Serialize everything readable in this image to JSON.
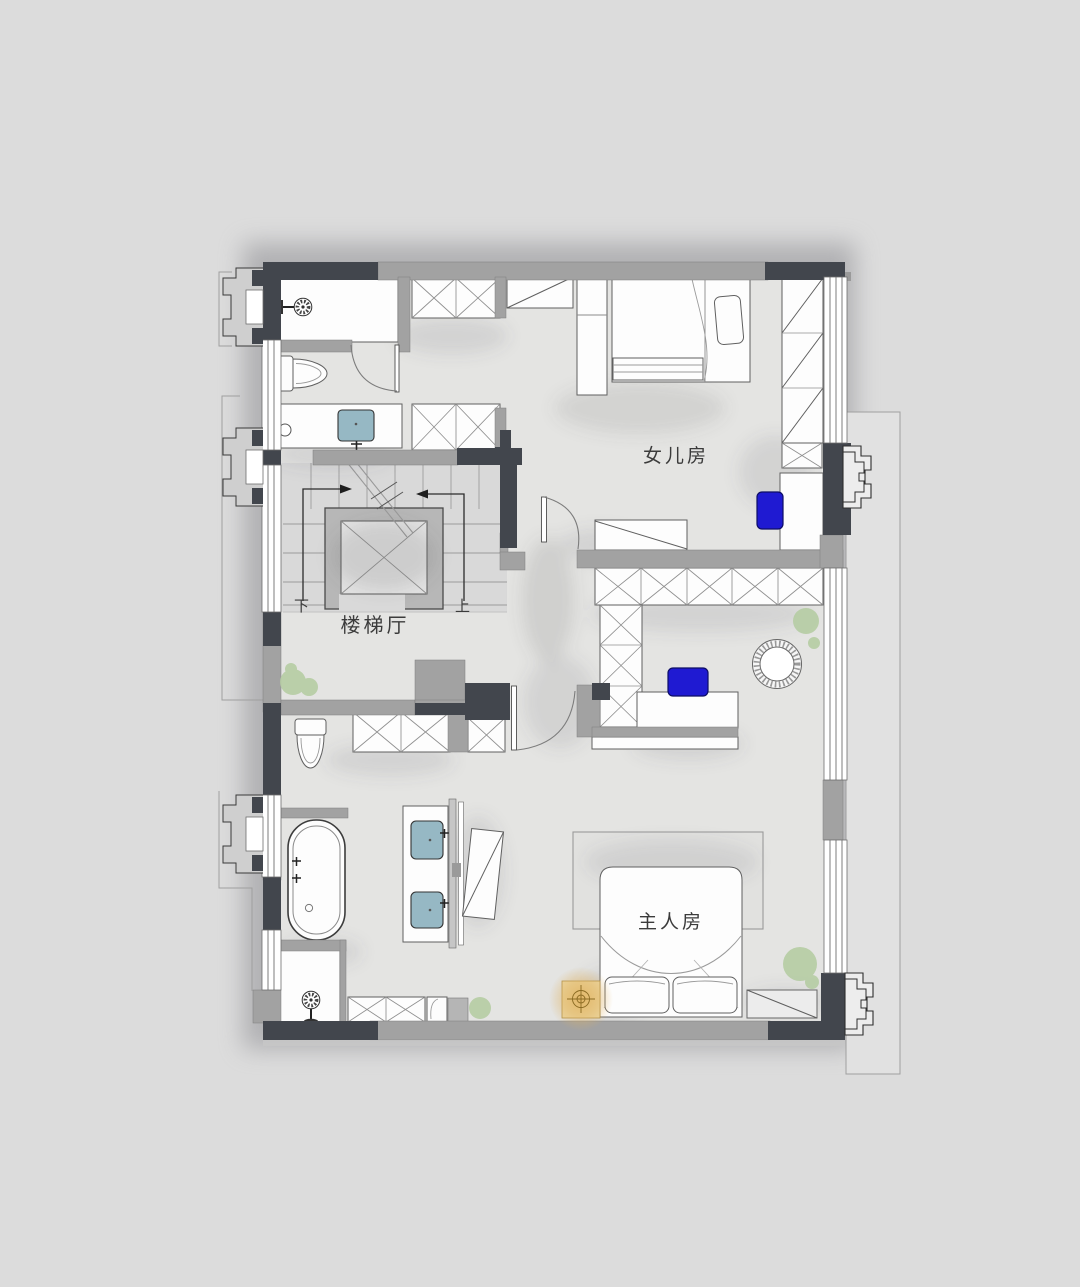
{
  "plan": {
    "labels": {
      "daughter_room": "女儿房",
      "master_room": "主人房",
      "stair_hall": "楼梯厅",
      "up": "上",
      "down": "下"
    },
    "colors": {
      "background": "#dcdcdc",
      "floor": "#e4e4e2",
      "stair_floor": "#d9d9d9",
      "wall_dark": "#42464d",
      "wall_gray": "#a2a2a2",
      "wall_gray_light": "#c7c7c7",
      "elevator_gray": "#b7b7b7",
      "furniture_fill": "#fdfdfd",
      "furniture_outline": "#606060",
      "accent_blue": "#1f1ad2",
      "sink_blue": "#96b8c4",
      "plant_green": "#b5cca3",
      "lamp_amber": "#ecd7a2",
      "lamp_glow": "#dfae5e",
      "label_text": "#3b3b3b"
    }
  }
}
